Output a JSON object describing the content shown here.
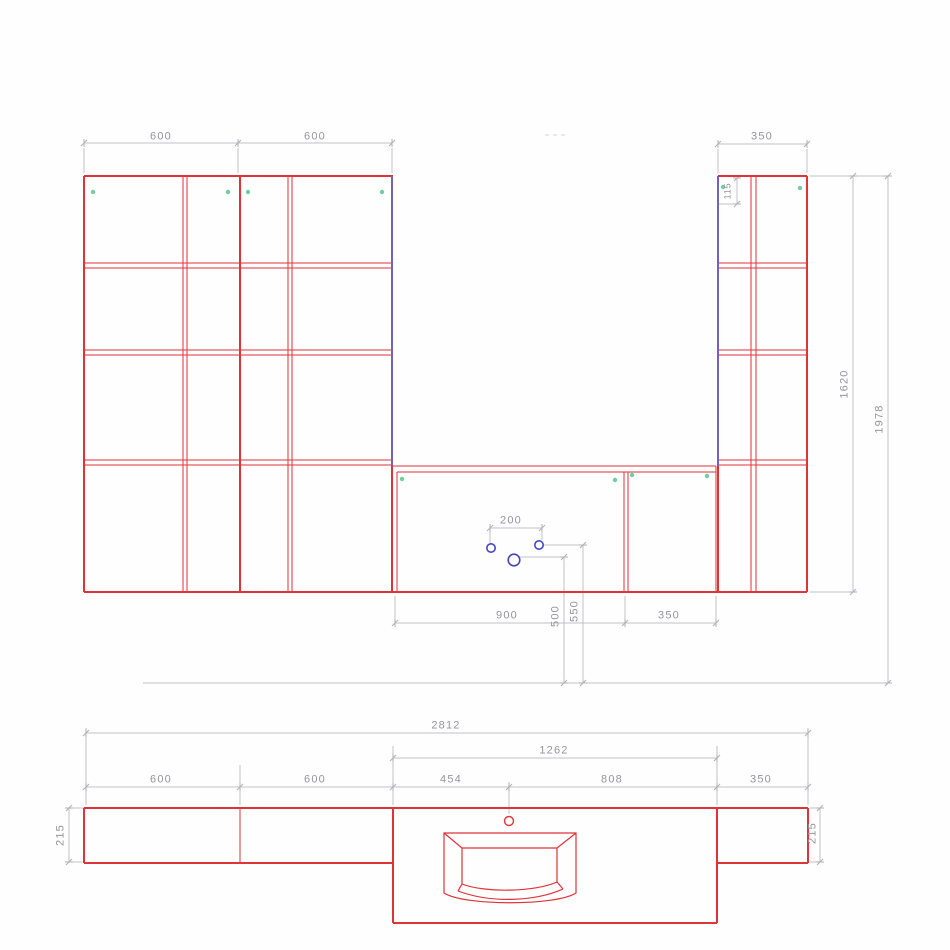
{
  "drawing": {
    "type": "bathroom-furniture-elevation-and-plan",
    "views": {
      "elevation": "front elevation with wall cabinets and vanity unit",
      "plan": "top plan view with countertop and wash basin"
    }
  },
  "elevation": {
    "top_dims": {
      "left_a": "600",
      "left_b": "600",
      "right": "350"
    },
    "heights": {
      "cabinet": "1620",
      "total": "1978",
      "hinge_offset": "115"
    },
    "vanity": {
      "hole_spacing": "200",
      "door_width": "900",
      "side_width": "350",
      "hole_height_center": "500",
      "hole_height_pair": "550"
    }
  },
  "plan": {
    "total_width": "2812",
    "counter_width": "1262",
    "segments": {
      "left_a": "600",
      "left_b": "600",
      "sink_offset": "454",
      "sink_span": "808",
      "right": "350"
    },
    "depths": {
      "left": "215",
      "right": "215"
    }
  },
  "colors": {
    "outline_red": "#df3338",
    "dimension_gray": "#c2c2c6",
    "dimension_text": "#95959a",
    "selected_edge_blue": "#6f63bd",
    "drill_hole_blue": "#4545c4",
    "hinge_marker_green": "#54c98c"
  }
}
